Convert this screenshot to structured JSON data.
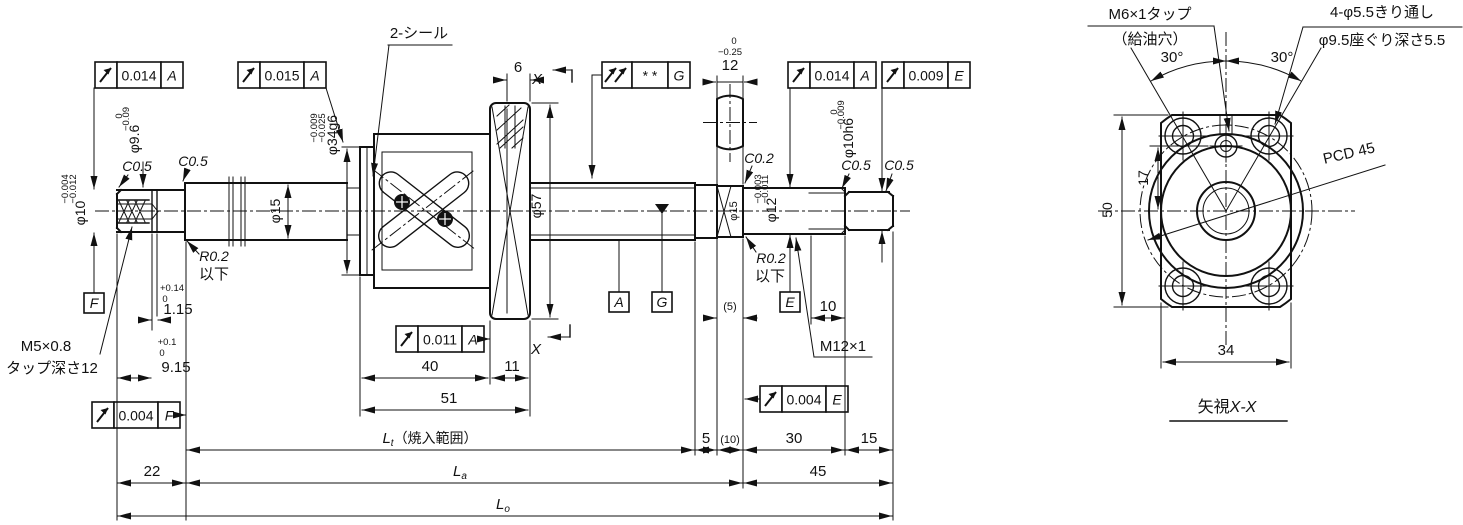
{
  "side_view": {
    "notes": {
      "seal": "2-シール",
      "tap_left_1": "M5×0.8",
      "tap_left_2": "タップ深さ12",
      "fillet_left_1": "R0.2",
      "fillet_left_2": "以下",
      "fillet_right_1": "R0.2",
      "fillet_right_2": "以下",
      "thread_right": "M12×1",
      "section_x_upper": "X",
      "section_x_lower": "X"
    },
    "chamfers": {
      "left_1": "C0.5",
      "left_2": "C0.5",
      "mid": "C0.2",
      "right_1": "C0.5",
      "right_2": "C0.5"
    },
    "diameters": {
      "d10": {
        "label": "φ10",
        "tol_u": "−0.004",
        "tol_l": "−0.012"
      },
      "d9_6": {
        "label": "φ9.6",
        "tol_u": "0",
        "tol_l": "−0.09"
      },
      "d15": {
        "label": "φ15"
      },
      "d34": {
        "label": "φ34g6",
        "tol_u": "−0.009",
        "tol_l": "−0.025"
      },
      "d57": {
        "label": "φ57"
      },
      "d15r": {
        "label": "φ15"
      },
      "d12": {
        "label": "φ12",
        "tol_u": "−0.003",
        "tol_l": "−0.011"
      },
      "d10h6": {
        "label": "φ10h6",
        "tol_u": "0",
        "tol_l": "−0.009"
      }
    },
    "dims": {
      "flange_width": "6",
      "flats": {
        "value": "12",
        "tol_u": "0",
        "tol_l": "−0.25"
      },
      "groove_w": {
        "value": "1.15",
        "tol_u": "+0.14",
        "tol_l": "0"
      },
      "groove_pos": {
        "value": "9.15",
        "tol_u": "+0.1",
        "tol_l": "0"
      },
      "nut_40": "40",
      "nut_11": "11",
      "nut_51": "51",
      "relief_5": "(5)",
      "thread_10": "10",
      "bottom": {
        "d22": "22",
        "d5": "5",
        "d10p": "(10)",
        "d30": "30",
        "d15": "15",
        "d45": "45"
      },
      "lt": {
        "letter": "L",
        "sub": "t",
        "note": "（焼入範囲）"
      },
      "la": {
        "letter": "L",
        "sub": "a"
      },
      "lo": {
        "letter": "L",
        "sub": "o"
      }
    },
    "fcf": {
      "f1": {
        "value": "0.014",
        "datum": "A"
      },
      "f2": {
        "value": "0.015",
        "datum": "A"
      },
      "f3": {
        "value": "* *",
        "datum": "G"
      },
      "f4": {
        "value": "0.014",
        "datum": "A"
      },
      "f5": {
        "value": "0.009",
        "datum": "E"
      },
      "f6": {
        "value": "0.011",
        "datum": "A"
      },
      "f7": {
        "value": "0.004",
        "datum": "F"
      },
      "f8": {
        "value": "0.004",
        "datum": "E"
      }
    },
    "datums": {
      "f": "F",
      "a": "A",
      "g": "G",
      "e": "E"
    }
  },
  "end_view": {
    "notes": {
      "oil_tap_1": "M6×1タップ",
      "oil_tap_2": "（給油穴）",
      "bolt_hole_1": "4-φ5.5きり通し",
      "bolt_hole_2": "φ9.5座ぐり深さ5.5",
      "pcd": "PCD 45"
    },
    "dims": {
      "h17": "17",
      "h50": "50",
      "w34": "34",
      "ang_l": "30°",
      "ang_r": "30°"
    },
    "view_label": {
      "prefix": "矢視",
      "suffix": "X-X"
    }
  },
  "colors": {
    "line": "#111111",
    "background": "#ffffff"
  }
}
